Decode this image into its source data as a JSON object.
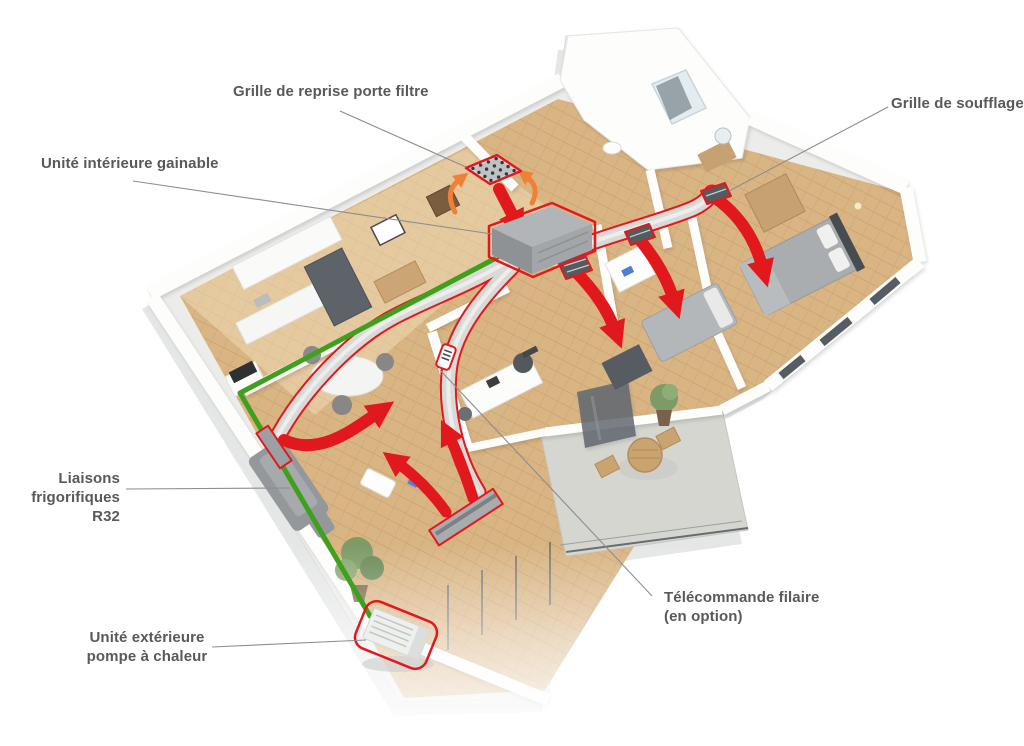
{
  "diagram": {
    "labels": {
      "grille_reprise": "Grille de reprise porte filtre",
      "grille_soufflage": "Grille de soufflage",
      "unite_interieure": "Unité intérieure gainable",
      "liaisons": "Liaisons\nfrigorifiques R32",
      "telecommande": "Télécommande filaire\n(en option)",
      "unite_exterieure": "Unité extérieure\npompe à chaleur"
    },
    "colors": {
      "accent_red": "#e2191c",
      "pipe_green": "#3fa01e",
      "arrow_orange": "#ef8136",
      "label_text": "#58595b",
      "duct_gray": "#d9d9d7",
      "wood_floor": "#d9b584"
    }
  }
}
